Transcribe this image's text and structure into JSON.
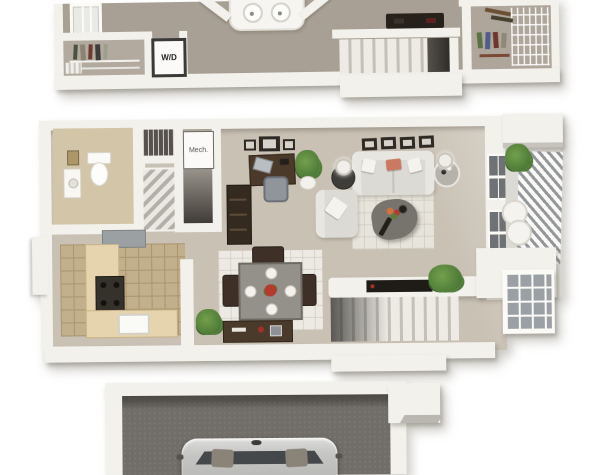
{
  "labels": {
    "washer_dryer": "W/D",
    "mechanical": "Mech."
  },
  "floors": [
    "upper-floor",
    "main-floor",
    "garage"
  ],
  "colors": {
    "canvas_bg": "#ffffff",
    "wall": "#f2f1ec",
    "wall_shade": "#d7d4cc",
    "carpet_upper": "#a8a094",
    "carpet_main": "#c9c1b4",
    "tile_bath": "#d3c5a7",
    "tile_kitchen": "#c2af8b",
    "tile_grid": "#a9946f",
    "counter": "#e5d4ae",
    "rug_living": "#e7e4dc",
    "rug_dining": "#eceae3",
    "wood_dark": "#3a2d21",
    "sofa": "#dcdad4",
    "pillow_accent": "#ca7a62",
    "plant": "#4e7a37",
    "stairs_light": "#edebe4",
    "stairs_dark": "#c3c0b8",
    "garage_floor": "#716e69",
    "car_body": "#c6c6c4",
    "glass_dark": "#45484b"
  }
}
